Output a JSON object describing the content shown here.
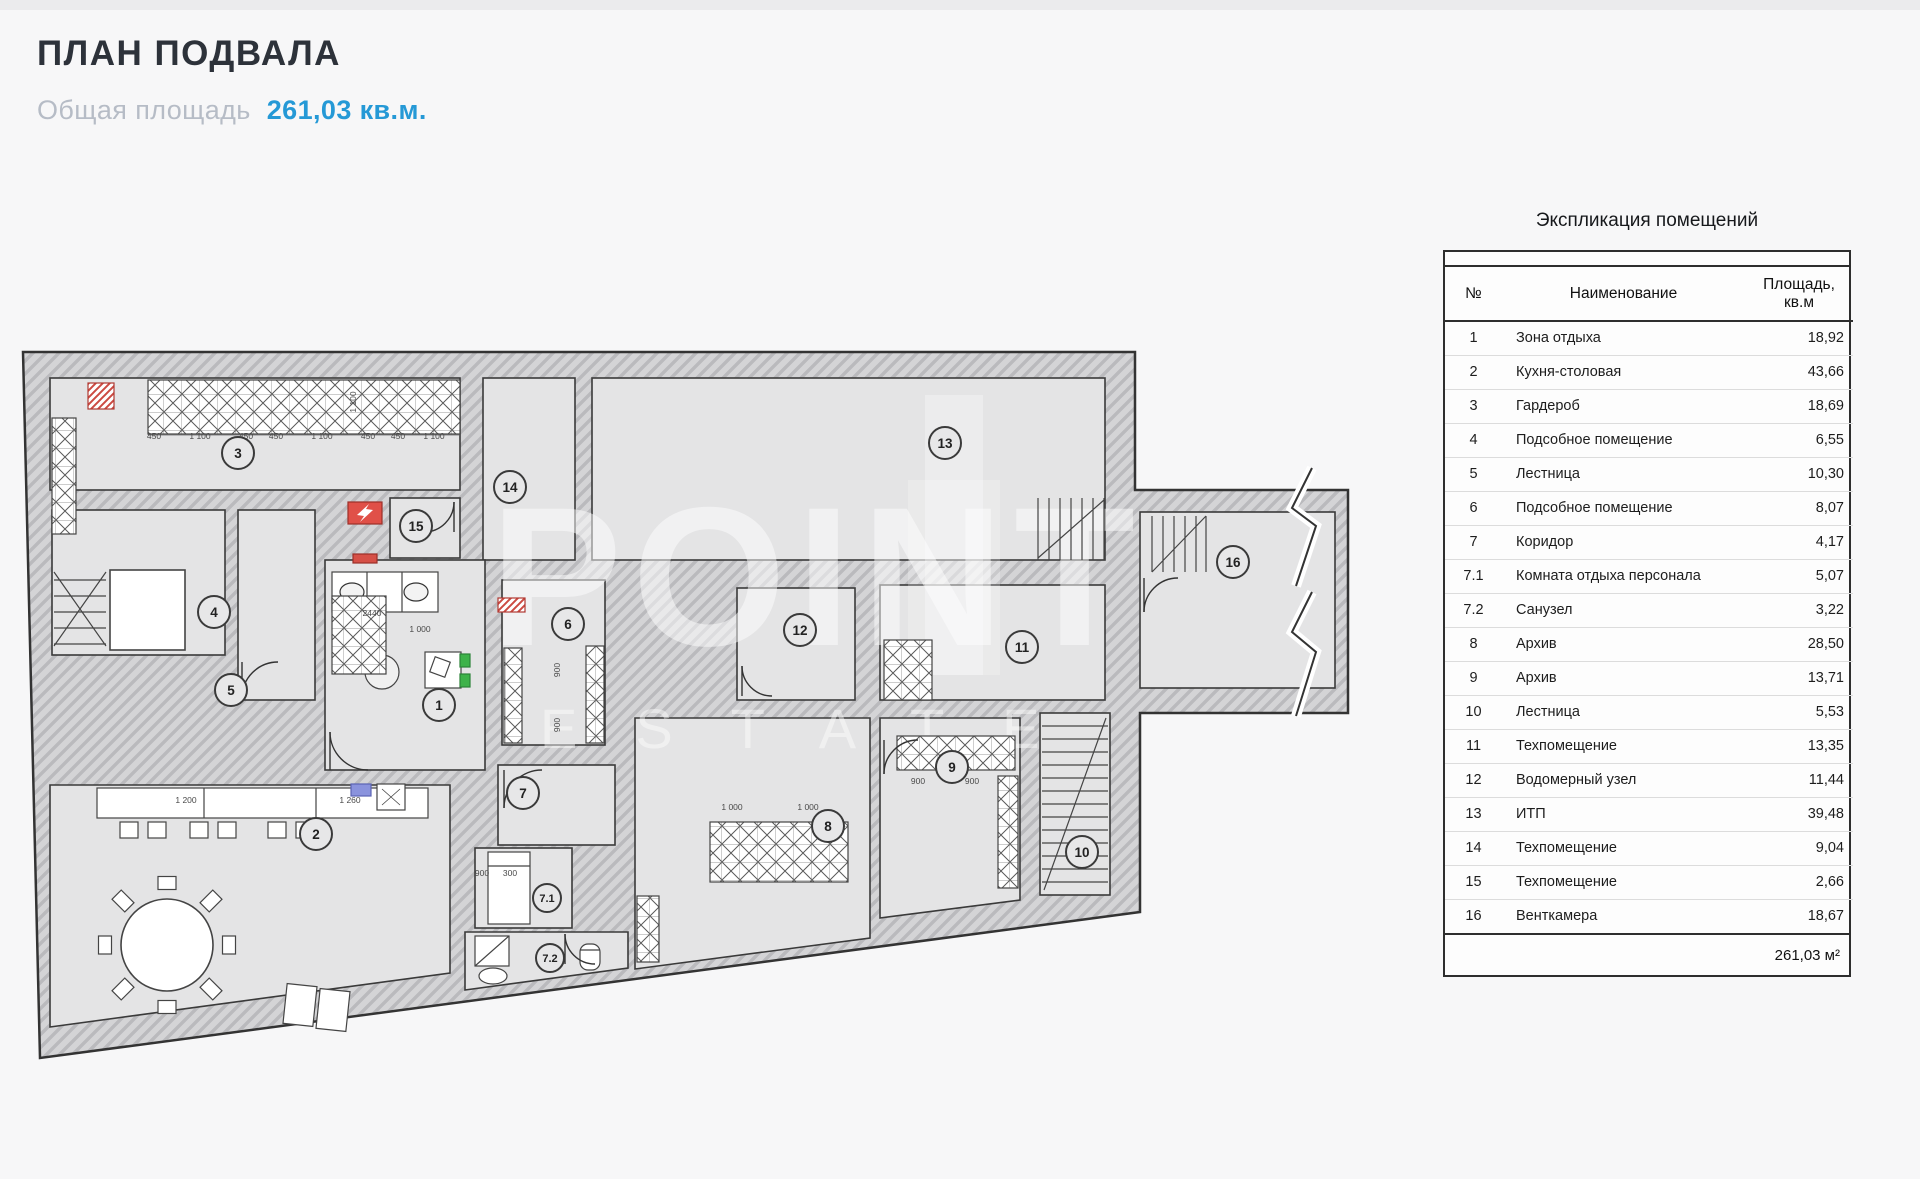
{
  "page": {
    "title": "ПЛАН ПОДВАЛА",
    "area_label": "Общая площадь",
    "area_value": "261,03 кв.м."
  },
  "legend": {
    "title": "Экспликация помещений",
    "columns": {
      "num": "№",
      "name": "Наименование",
      "area_line1": "Площадь,",
      "area_line2": "кв.м"
    },
    "rows": [
      {
        "n": "1",
        "name": "Зона отдыха",
        "area": "18,92"
      },
      {
        "n": "2",
        "name": "Кухня-столовая",
        "area": "43,66"
      },
      {
        "n": "3",
        "name": "Гардероб",
        "area": "18,69"
      },
      {
        "n": "4",
        "name": "Подсобное помещение",
        "area": "6,55"
      },
      {
        "n": "5",
        "name": "Лестница",
        "area": "10,30"
      },
      {
        "n": "6",
        "name": "Подсобное помещение",
        "area": "8,07"
      },
      {
        "n": "7",
        "name": "Коридор",
        "area": "4,17"
      },
      {
        "n": "7.1",
        "name": "Комната отдыха персонала",
        "area": "5,07"
      },
      {
        "n": "7.2",
        "name": "Санузел",
        "area": "3,22"
      },
      {
        "n": "8",
        "name": "Архив",
        "area": "28,50"
      },
      {
        "n": "9",
        "name": "Архив",
        "area": "13,71"
      },
      {
        "n": "10",
        "name": "Лестница",
        "area": "5,53"
      },
      {
        "n": "11",
        "name": "Техпомещение",
        "area": "13,35"
      },
      {
        "n": "12",
        "name": "Водомерный узел",
        "area": "11,44"
      },
      {
        "n": "13",
        "name": "ИТП",
        "area": "39,48"
      },
      {
        "n": "14",
        "name": "Техпомещение",
        "area": "9,04"
      },
      {
        "n": "15",
        "name": "Техпомещение",
        "area": "2,66"
      },
      {
        "n": "16",
        "name": "Венткамера",
        "area": "18,67"
      }
    ],
    "total": "261,03 м²"
  },
  "plan": {
    "watermark": {
      "line1": "POINT",
      "line2": "ESTATE"
    },
    "colors": {
      "accent_blue": "#2599d6",
      "wall_red": "#d6453d",
      "green": "#3eb24a"
    },
    "room_labels": [
      {
        "n": "1",
        "x": 419,
        "y": 365
      },
      {
        "n": "2",
        "x": 296,
        "y": 494
      },
      {
        "n": "3",
        "x": 218,
        "y": 113
      },
      {
        "n": "4",
        "x": 194,
        "y": 272
      },
      {
        "n": "5",
        "x": 211,
        "y": 350
      },
      {
        "n": "6",
        "x": 548,
        "y": 284
      },
      {
        "n": "7",
        "x": 503,
        "y": 453
      },
      {
        "n": "7.1",
        "x": 527,
        "y": 558
      },
      {
        "n": "7.2",
        "x": 530,
        "y": 618
      },
      {
        "n": "8",
        "x": 808,
        "y": 486
      },
      {
        "n": "9",
        "x": 932,
        "y": 427
      },
      {
        "n": "10",
        "x": 1062,
        "y": 512
      },
      {
        "n": "11",
        "x": 1002,
        "y": 307
      },
      {
        "n": "12",
        "x": 780,
        "y": 290
      },
      {
        "n": "13",
        "x": 925,
        "y": 103
      },
      {
        "n": "14",
        "x": 490,
        "y": 147
      },
      {
        "n": "15",
        "x": 396,
        "y": 186
      },
      {
        "n": "16",
        "x": 1213,
        "y": 222
      }
    ],
    "dim_labels": [
      {
        "t": "450",
        "x": 134,
        "y": 99
      },
      {
        "t": "1 100",
        "x": 180,
        "y": 99
      },
      {
        "t": "450",
        "x": 226,
        "y": 99
      },
      {
        "t": "450",
        "x": 256,
        "y": 99
      },
      {
        "t": "1 100",
        "x": 302,
        "y": 99
      },
      {
        "t": "450",
        "x": 348,
        "y": 99
      },
      {
        "t": "450",
        "x": 378,
        "y": 99
      },
      {
        "t": "1 100",
        "x": 414,
        "y": 99
      },
      {
        "t": "1 100",
        "x": 336,
        "y": 62,
        "r": -90
      },
      {
        "t": "1 200",
        "x": 166,
        "y": 463
      },
      {
        "t": "1 260",
        "x": 330,
        "y": 463
      },
      {
        "t": "2440",
        "x": 352,
        "y": 276
      },
      {
        "t": "1 000",
        "x": 400,
        "y": 292
      },
      {
        "t": "900",
        "x": 540,
        "y": 330,
        "r": -90
      },
      {
        "t": "900",
        "x": 540,
        "y": 385,
        "r": -90
      },
      {
        "t": "900",
        "x": 462,
        "y": 536
      },
      {
        "t": "300",
        "x": 490,
        "y": 536
      },
      {
        "t": "1 000",
        "x": 712,
        "y": 470
      },
      {
        "t": "1 000",
        "x": 788,
        "y": 470
      },
      {
        "t": "900",
        "x": 898,
        "y": 444
      },
      {
        "t": "900",
        "x": 952,
        "y": 444
      }
    ]
  }
}
